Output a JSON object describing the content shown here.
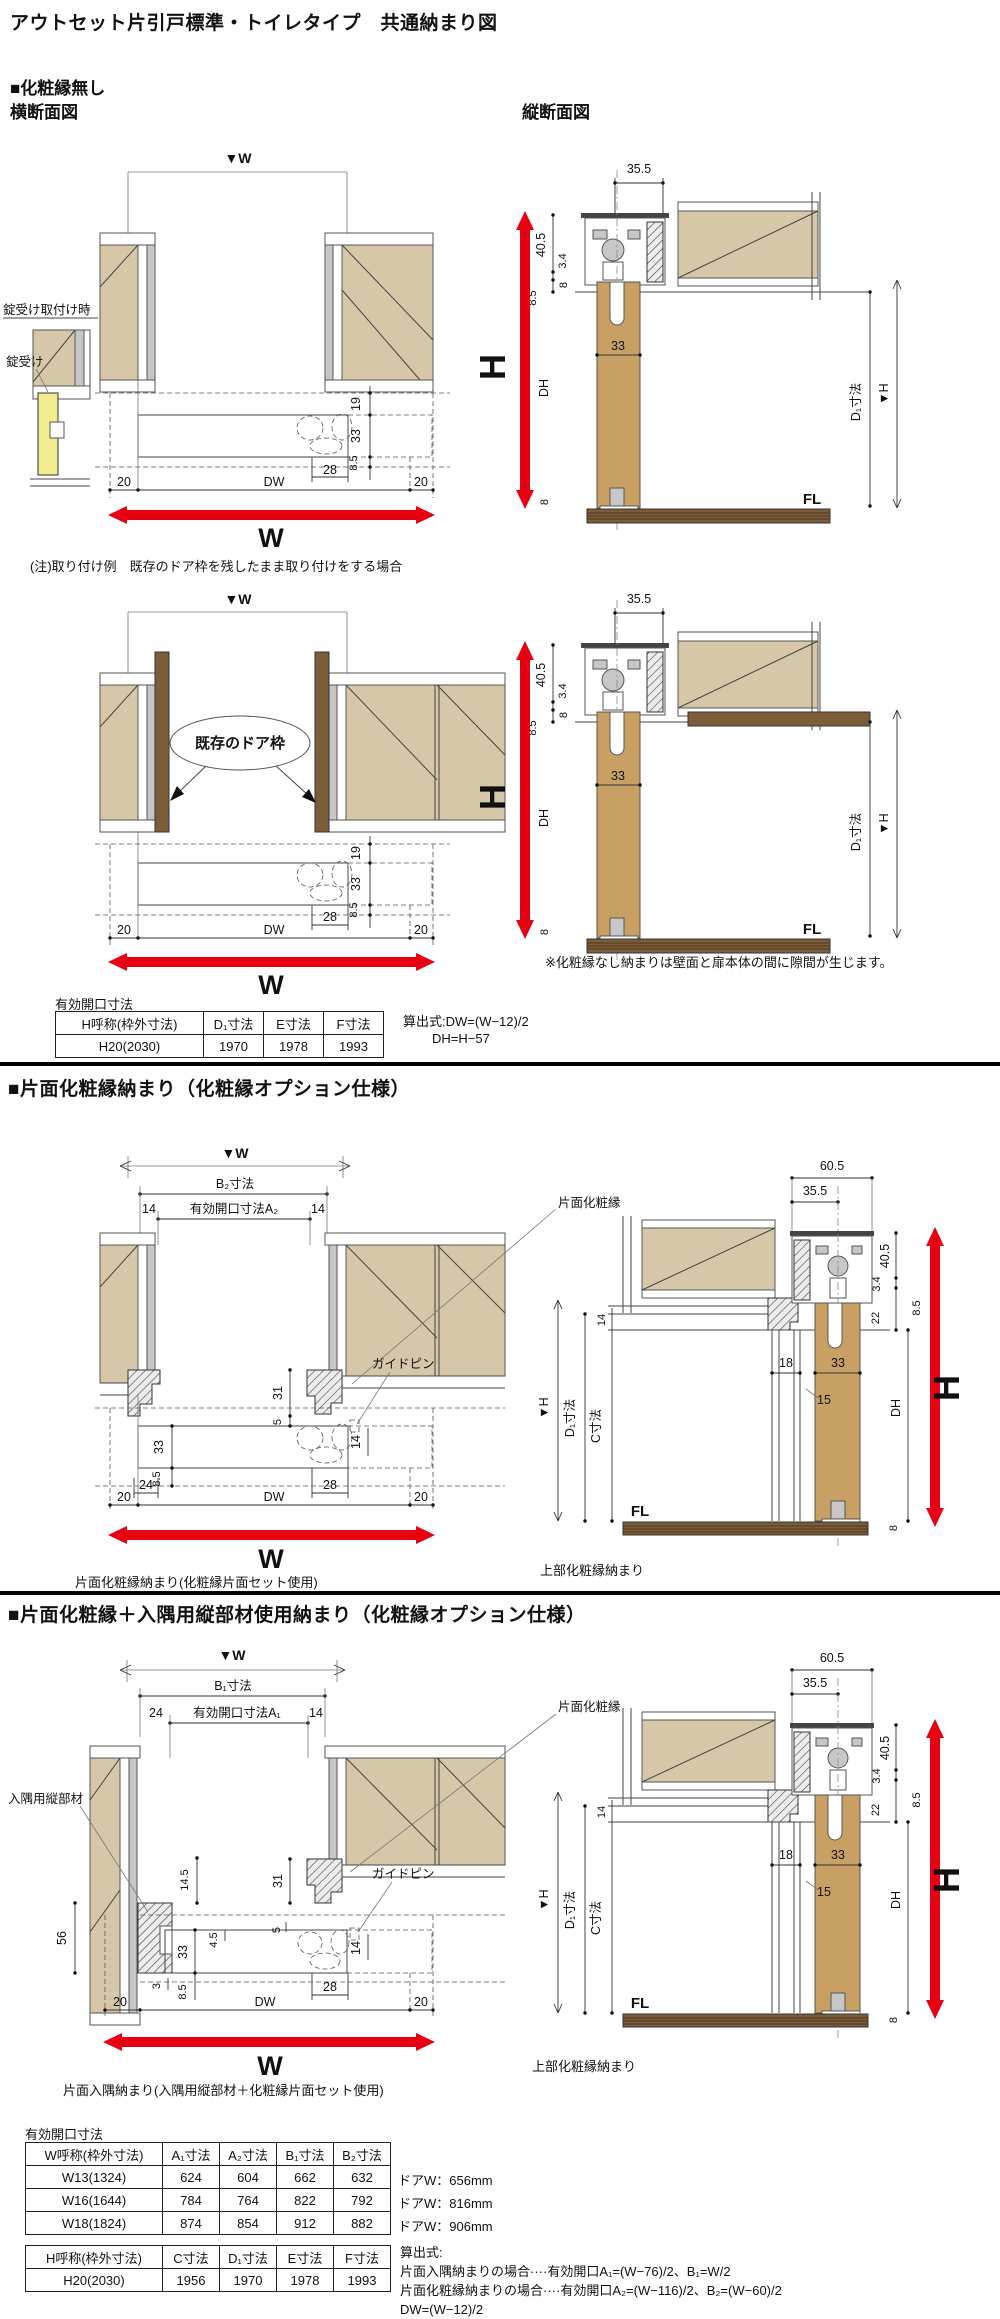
{
  "title": "アウトセット片引戸標準・トイレタイプ　共通納まり図",
  "colors": {
    "red": "#e60012",
    "wall_tan": "#d6c7a8",
    "door_tan": "#c9a064",
    "wood_brown": "#7d5c39",
    "highlight_yellow": "#f2eb90"
  },
  "sec1": {
    "heading": "■化粧縁無し",
    "cross_title": "横断面図",
    "vert_title": "縦断面図",
    "w_marker": "▼W",
    "w": "W",
    "lock_title": "錠受け取付け時",
    "lock_label": "錠受け",
    "cd": {
      "d19": "19",
      "d33": "33",
      "d85": "8.5",
      "d20": "20",
      "dw": "DW",
      "d28": "28"
    },
    "vd": {
      "d355": "35.5",
      "d405": "40.5",
      "d34": "3.4",
      "d85": "8.5",
      "d8": "8",
      "d33": "33",
      "dh": "DH",
      "d1": "D₁寸法",
      "hm": "▼H",
      "h": "H",
      "fl": "FL"
    },
    "install_note": "(注)取り付け例　既存のドア枠を残したまま取り付けをする場合",
    "existing_frame": "既存のドア枠",
    "gap_note": "※化粧縁なし納まりは壁面と扉本体の間に隙間が生じます。",
    "table_caption": "有効開口寸法",
    "th": [
      "H呼称(枠外寸法)",
      "D₁寸法",
      "E寸法",
      "F寸法"
    ],
    "tr": [
      "H20(2030)",
      "1970",
      "1978",
      "1993"
    ],
    "f1": "算出式:DW=(W−12)/2",
    "f2": "DH=H−57"
  },
  "sec2": {
    "heading": "■片面化粧縁納まり（化粧縁オプション仕様）",
    "w_marker": "▼W",
    "w": "W",
    "b": "B₂寸法",
    "open": "有効開口寸法A₂",
    "kesho": "片面化粧縁",
    "guide": "ガイドピン",
    "cd": {
      "d14": "14",
      "d31": "31",
      "d5": "5",
      "d33": "33",
      "d85": "8.5",
      "d24": "24",
      "d28": "28",
      "d20": "20",
      "dw": "DW"
    },
    "caption": "片面化粧縁納まり(化粧縁片面セット使用)"
  },
  "sec3": {
    "heading": "■片面化粧縁＋入隅用縦部材使用納まり（化粧縁オプション仕様）",
    "w_marker": "▼W",
    "w": "W",
    "b": "B₁寸法",
    "open": "有効開口寸法A₁",
    "irisumi": "入隅用縦部材",
    "kesho": "片面化粧縁",
    "guide": "ガイドピン",
    "cd": {
      "d24": "24",
      "d14": "14",
      "d56": "56",
      "d145": "14.5",
      "d31": "31",
      "d5": "5",
      "d33": "33",
      "d45": "4.5",
      "d3": "3",
      "d20": "20",
      "d85": "8.5",
      "d28": "28",
      "dw": "DW"
    },
    "caption": "片面入隅納まり(入隅用縦部材＋化粧縁片面セット使用)"
  },
  "vsec": {
    "d605": "60.5",
    "d355": "35.5",
    "d405": "40.5",
    "d34": "3.4",
    "d85": "8.5",
    "d22": "22",
    "d14": "14",
    "d18": "18",
    "d33": "33",
    "d15": "15",
    "dh": "DH",
    "d1": "D₁寸法",
    "c": "C寸法",
    "hm": "▼H",
    "h": "H",
    "fl": "FL",
    "d8": "8",
    "caption": "上部化粧縁納まり"
  },
  "bottom": {
    "caption": "有効開口寸法",
    "w_table": {
      "headers": [
        "W呼称(枠外寸法)",
        "A₁寸法",
        "A₂寸法",
        "B₁寸法",
        "B₂寸法"
      ],
      "rows": [
        [
          "W13(1324)",
          "624",
          "604",
          "662",
          "632"
        ],
        [
          "W16(1644)",
          "784",
          "764",
          "822",
          "792"
        ],
        [
          "W18(1824)",
          "874",
          "854",
          "912",
          "882"
        ]
      ],
      "notes": [
        "ドアW：656mm",
        "ドアW：816mm",
        "ドアW：906mm"
      ]
    },
    "h_table": {
      "headers": [
        "H呼称(枠外寸法)",
        "C寸法",
        "D₁寸法",
        "E寸法",
        "F寸法"
      ],
      "rows": [
        [
          "H20(2030)",
          "1956",
          "1970",
          "1978",
          "1993"
        ]
      ]
    },
    "formulas": [
      "算出式:",
      "片面入隅納まりの場合····有効開口A₁=(W−76)/2、B₁=W/2",
      "片面化粧縁納まりの場合····有効開口A₂=(W−116)/2、B₂=(W−60)/2",
      "DW=(W−12)/2"
    ]
  }
}
